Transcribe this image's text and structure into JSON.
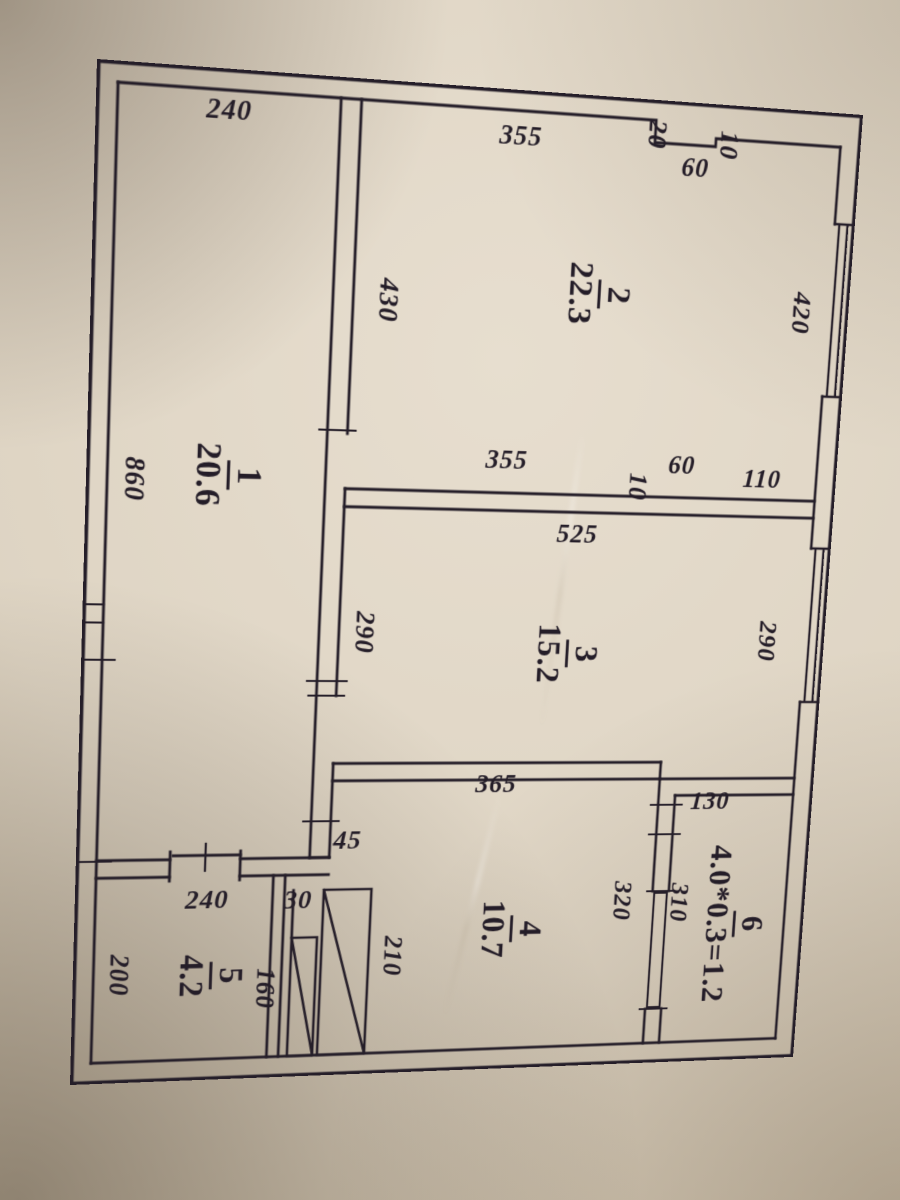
{
  "colors": {
    "paper": "#ded4c3",
    "ink": "#241d28"
  },
  "floorplan": {
    "rooms": [
      {
        "num": "1",
        "area": "20.6"
      },
      {
        "num": "2",
        "area": "22.3"
      },
      {
        "num": "3",
        "area": "15.2"
      },
      {
        "num": "4",
        "area": "10.7"
      },
      {
        "num": "5",
        "area": "4.2"
      },
      {
        "num": "6",
        "area": "4.0*0.3=1.2"
      }
    ],
    "dimensions": [
      "240",
      "355",
      "20",
      "60",
      "10",
      "430",
      "420",
      "355",
      "60",
      "10",
      "110",
      "525",
      "290",
      "290",
      "860",
      "365",
      "130",
      "45",
      "320",
      "310",
      "30",
      "240",
      "160",
      "210",
      "200"
    ]
  }
}
